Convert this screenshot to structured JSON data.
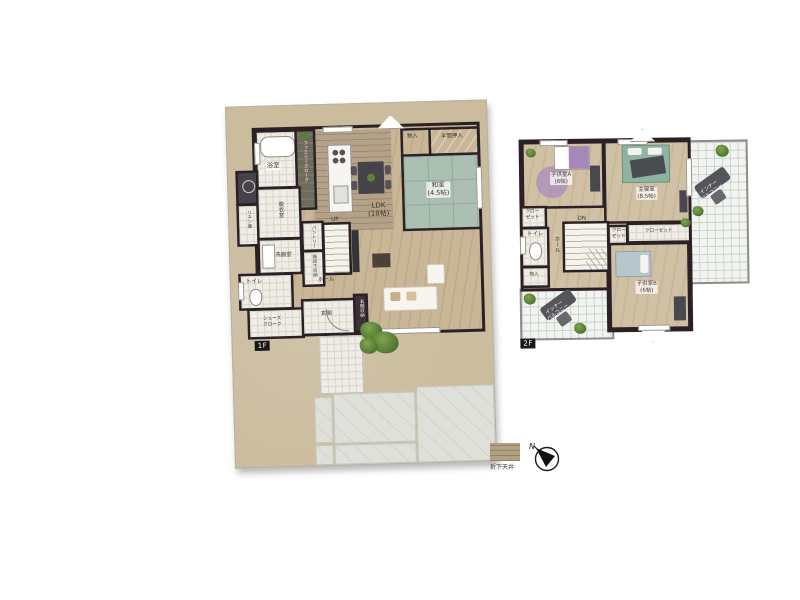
{
  "floor1": {
    "tag": "1F",
    "bath": "浴室",
    "family_cloak": "ファミリークローク",
    "linen": "リネン庫",
    "datsui": "脱衣室",
    "senmen": "洗面室",
    "toilet": "トイレ",
    "shoes_cloak_1": "シューズ",
    "shoes_cloak_2": "クローク",
    "genkan": "玄関",
    "genkan_storage": "玄関収納",
    "hall": "ホール",
    "pantry": "パントリー",
    "under_stairs": "階段下収納",
    "up": "UP",
    "ldk": "LDK",
    "ldk_size": "(18帖)",
    "washitsu": "和室",
    "washitsu_size": "(4.5帖)",
    "monoire": "物入",
    "oshiire": "半間押入"
  },
  "floor2": {
    "tag": "2F",
    "kids_a": "子供室A",
    "kids_a_size": "(6帖)",
    "master": "主寝室",
    "master_size": "(8.5帖)",
    "kids_b": "子供室B",
    "kids_b_size": "(6帖)",
    "closet_1": "クロー",
    "closet_2": "ゼット",
    "closet_wide": "クローゼット",
    "toilet": "トイレ",
    "hall": "ホール",
    "dn": "DN",
    "monoire": "物入",
    "balcony_1": "インナー",
    "balcony_2": "バルコニー"
  },
  "legend": {
    "swatch_label": "折下天井",
    "compass_north": "N"
  },
  "colors": {
    "wall": "#2b2026",
    "lot_ground": "#cbbc9e",
    "tatami": "#abbfb2",
    "dropped_ceiling": "#b3a287",
    "wood_floor": "#c9b697"
  }
}
